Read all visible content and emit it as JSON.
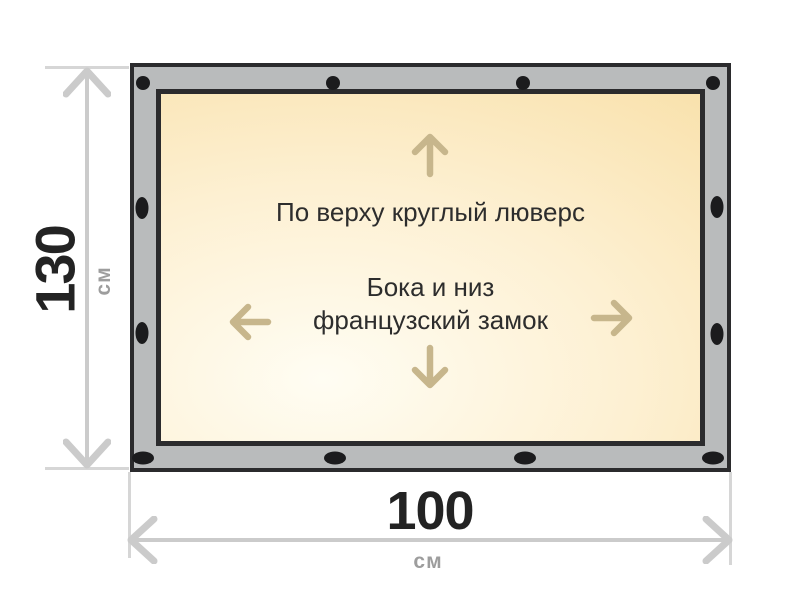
{
  "dimensions": {
    "height": {
      "value": "130",
      "unit": "см"
    },
    "width": {
      "value": "100",
      "unit": "см"
    }
  },
  "banner": {
    "top_edge_note": "По верху круглый люверс",
    "sides_note_line1": "Бока и низ",
    "sides_note_line2": "французский замок"
  },
  "colors": {
    "frame_gray": "#b9bbbc",
    "frame_border": "#2b2b2d",
    "grommet_black": "#1b1b1d",
    "canvas_light": "#fffdf3",
    "canvas_gold": "#f8dfa6",
    "arrow_tan": "#c7b68c",
    "dimension_gray": "#cbcbcb",
    "dimension_value_text": "#232323",
    "unit_text": "#9d9d9d",
    "note_text": "#2d2d2d"
  }
}
